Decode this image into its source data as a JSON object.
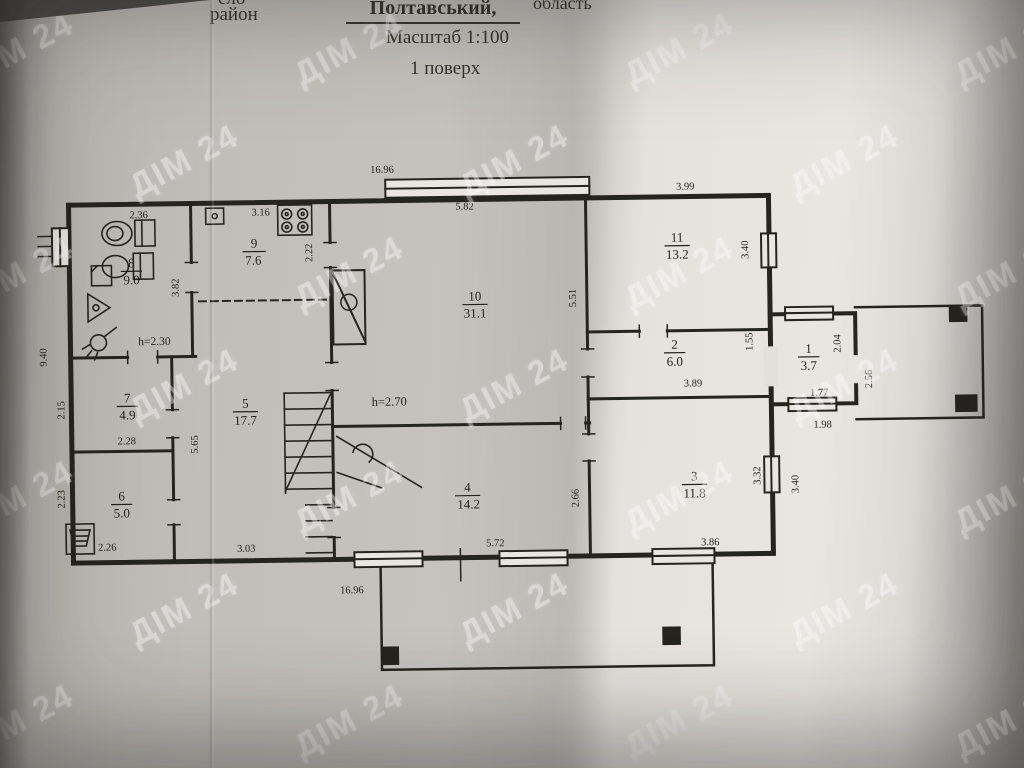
{
  "header": {
    "top_partial": "ело",
    "district_label": "район",
    "district_name": "Полтавський,",
    "region_label": "область",
    "scale": "Масштаб 1:100",
    "floor": "1 поверх"
  },
  "watermark": {
    "text": "ДІМ 24",
    "color": "#ffffff"
  },
  "photo": {
    "paper_light": "#e9e6e1",
    "paper_mid": "#c6c3be",
    "paper_dark": "#8c8a86",
    "ink": "#26241f"
  },
  "plan": {
    "rooms": [
      {
        "number": "1",
        "area": "3.7"
      },
      {
        "number": "2",
        "area": "6.0"
      },
      {
        "number": "3",
        "area": "11.8"
      },
      {
        "number": "4",
        "area": "14.2"
      },
      {
        "number": "5",
        "area": "17.7"
      },
      {
        "number": "6",
        "area": "5.0"
      },
      {
        "number": "7",
        "area": "4.9"
      },
      {
        "number": "8",
        "area": "9.0"
      },
      {
        "number": "9",
        "area": "7.6"
      },
      {
        "number": "10",
        "area": "31.1"
      },
      {
        "number": "11",
        "area": "13.2"
      }
    ],
    "heights": {
      "room8": "h=2.30",
      "room10": "h=2.70"
    },
    "dims": {
      "top": "16.96",
      "bottom": "16.96",
      "left": "9.40",
      "r8_top": "2.36",
      "r9_top": "3.16",
      "r9_right": "2.22",
      "r8_right": "3.82",
      "r10_top": "5.82",
      "r10_right": "5.51",
      "r11_top": "3.99",
      "r11_right": "3.40",
      "r2_right": "1.55",
      "r2_bottom": "3.89",
      "r1_side": "2.04",
      "r1_bottom": "1.77",
      "r1_outer_bottom": "1.98",
      "porch_right": "2.56",
      "r3_right": "3.32",
      "r3_outer_right": "3.40",
      "r3_bottom": "3.86",
      "r4_bottom": "5.72",
      "r4_right": "2.66",
      "r7_left": "2.15",
      "r7_bottom": "2.28",
      "r6_left": "2.23",
      "r6_bottom": "2.26",
      "r5_left": "5.65",
      "r5_bottom": "3.03"
    }
  }
}
